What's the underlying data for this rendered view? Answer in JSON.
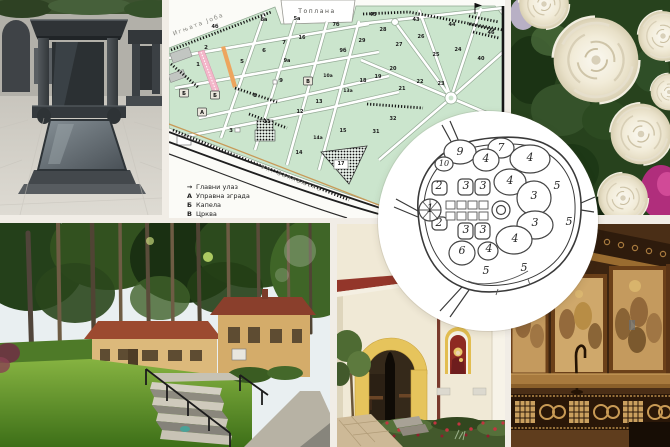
{
  "collage": {
    "photos": [
      {
        "name": "tombstones-photo"
      },
      {
        "name": "cemetery-map"
      },
      {
        "name": "white-roses-photo"
      },
      {
        "name": "park-alley-photo"
      },
      {
        "name": "chapel-photo"
      },
      {
        "name": "church-interior-photo"
      },
      {
        "name": "old-plan-inset"
      }
    ]
  },
  "map": {
    "street_top": "Игњата Јоба",
    "heating_plant": "Топлана",
    "street_bottom": "Ул. Заплањска",
    "legend": [
      {
        "symbol": "→",
        "label": "Главни улаз"
      },
      {
        "symbol": "А",
        "label": "Управна зграда"
      },
      {
        "symbol": "Б",
        "label": "Капела"
      },
      {
        "symbol": "В",
        "label": "Црква"
      }
    ],
    "markers": [
      {
        "label": "Б",
        "x": 15,
        "y": 93
      },
      {
        "label": "Б",
        "x": 46,
        "y": 95
      },
      {
        "label": "А",
        "x": 33,
        "y": 112
      },
      {
        "label": "В",
        "x": 139,
        "y": 81
      }
    ],
    "plots": [
      {
        "n": "4б",
        "x": 46,
        "y": 28
      },
      {
        "n": "8а",
        "x": 95,
        "y": 21
      },
      {
        "n": "5а",
        "x": 128,
        "y": 20
      },
      {
        "n": "7б",
        "x": 167,
        "y": 26
      },
      {
        "n": "45",
        "x": 204,
        "y": 16
      },
      {
        "n": "43",
        "x": 247,
        "y": 21
      },
      {
        "n": "44",
        "x": 283,
        "y": 26
      },
      {
        "n": "46",
        "x": 322,
        "y": 34
      },
      {
        "n": "2",
        "x": 37,
        "y": 49
      },
      {
        "n": "1",
        "x": 29,
        "y": 66
      },
      {
        "n": "5",
        "x": 73,
        "y": 63
      },
      {
        "n": "6",
        "x": 95,
        "y": 52
      },
      {
        "n": "7",
        "x": 115,
        "y": 44
      },
      {
        "n": "16",
        "x": 133,
        "y": 39
      },
      {
        "n": "9а",
        "x": 118,
        "y": 62
      },
      {
        "n": "9б",
        "x": 174,
        "y": 52
      },
      {
        "n": "9",
        "x": 112,
        "y": 82
      },
      {
        "n": "8",
        "x": 86,
        "y": 97
      },
      {
        "n": "10а",
        "x": 159,
        "y": 77
      },
      {
        "n": "13а",
        "x": 179,
        "y": 92
      },
      {
        "n": "13",
        "x": 150,
        "y": 103
      },
      {
        "n": "18",
        "x": 194,
        "y": 82
      },
      {
        "n": "19",
        "x": 209,
        "y": 78
      },
      {
        "n": "20",
        "x": 224,
        "y": 70
      },
      {
        "n": "29",
        "x": 193,
        "y": 42
      },
      {
        "n": "28",
        "x": 214,
        "y": 31
      },
      {
        "n": "27",
        "x": 230,
        "y": 46
      },
      {
        "n": "26",
        "x": 252,
        "y": 38
      },
      {
        "n": "25",
        "x": 267,
        "y": 56
      },
      {
        "n": "24",
        "x": 289,
        "y": 51
      },
      {
        "n": "40",
        "x": 312,
        "y": 60
      },
      {
        "n": "21",
        "x": 233,
        "y": 90
      },
      {
        "n": "22",
        "x": 251,
        "y": 83
      },
      {
        "n": "23",
        "x": 272,
        "y": 85
      },
      {
        "n": "11",
        "x": 98,
        "y": 123
      },
      {
        "n": "12",
        "x": 131,
        "y": 113
      },
      {
        "n": "3",
        "x": 62,
        "y": 132
      },
      {
        "n": "14а",
        "x": 149,
        "y": 139
      },
      {
        "n": "14",
        "x": 130,
        "y": 154
      },
      {
        "n": "15",
        "x": 174,
        "y": 132
      },
      {
        "n": "31",
        "x": 207,
        "y": 133
      },
      {
        "n": "32",
        "x": 224,
        "y": 120
      },
      {
        "n": "17",
        "x": 172,
        "y": 165
      }
    ],
    "colors": {
      "field_green": "#cbe5cd",
      "alley_pink": "#f3b6c9",
      "alley_orange": "#eda55e",
      "tree_black": "#141414",
      "road_black": "#1f1f1f"
    }
  },
  "inset": {
    "labels": [
      {
        "n": "9",
        "x": 82,
        "y": 44
      },
      {
        "n": "7",
        "x": 123,
        "y": 40
      },
      {
        "n": "10",
        "x": 66,
        "y": 55
      },
      {
        "n": "4",
        "x": 108,
        "y": 51
      },
      {
        "n": "4",
        "x": 152,
        "y": 50
      },
      {
        "n": "4",
        "x": 132,
        "y": 73
      },
      {
        "n": "2",
        "x": 61,
        "y": 78
      },
      {
        "n": "3",
        "x": 88,
        "y": 78
      },
      {
        "n": "3",
        "x": 105,
        "y": 78
      },
      {
        "n": "5",
        "x": 179,
        "y": 78
      },
      {
        "n": "3",
        "x": 156,
        "y": 88
      },
      {
        "n": "1",
        "x": 52,
        "y": 101
      },
      {
        "n": "3",
        "x": 157,
        "y": 115
      },
      {
        "n": "5",
        "x": 191,
        "y": 114
      },
      {
        "n": "2",
        "x": 61,
        "y": 115
      },
      {
        "n": "3",
        "x": 88,
        "y": 122
      },
      {
        "n": "3",
        "x": 105,
        "y": 122
      },
      {
        "n": "4",
        "x": 137,
        "y": 131
      },
      {
        "n": "6",
        "x": 84,
        "y": 143
      },
      {
        "n": "4",
        "x": 111,
        "y": 141
      },
      {
        "n": "5",
        "x": 108,
        "y": 163
      },
      {
        "n": "5",
        "x": 146,
        "y": 160
      }
    ]
  }
}
